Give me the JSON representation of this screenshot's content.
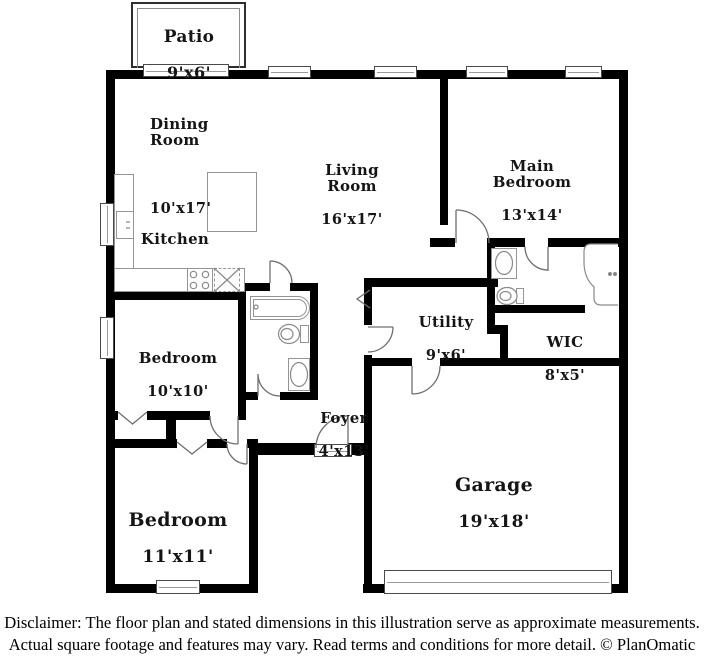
{
  "title": "Floor plan",
  "rooms": {
    "patio": {
      "name": "Patio",
      "dims": "9'x6'"
    },
    "dining": {
      "name": "Dining\nRoom",
      "dims": "10'x17'"
    },
    "kitchen": {
      "name": "Kitchen"
    },
    "living": {
      "name": "Living\nRoom",
      "dims": "16'x17'"
    },
    "main_bedroom": {
      "name": "Main\nBedroom",
      "dims": "13'x14'"
    },
    "utility": {
      "name": "Utility",
      "dims": "9'x6'"
    },
    "wic": {
      "name": "WIC",
      "dims": "8'x5'"
    },
    "bedroom_10": {
      "name": "Bedroom",
      "dims": "10'x10'"
    },
    "foyer": {
      "name": "Foyer",
      "dims": "4'x13'"
    },
    "bedroom_11": {
      "name": "Bedroom",
      "dims": "11'x11'"
    },
    "garage": {
      "name": "Garage",
      "dims": "19'x18'"
    }
  },
  "disclaimer": {
    "line1": "Disclaimer: The floor plan and stated dimensions in this illustration serve as approximate measurements.",
    "line2": "Actual square footage and features may vary. Read terms and conditions for more detail. © PlanOmatic"
  },
  "colors": {
    "wall": "#000000",
    "fixture_line": "#949494",
    "background": "#ffffff"
  }
}
